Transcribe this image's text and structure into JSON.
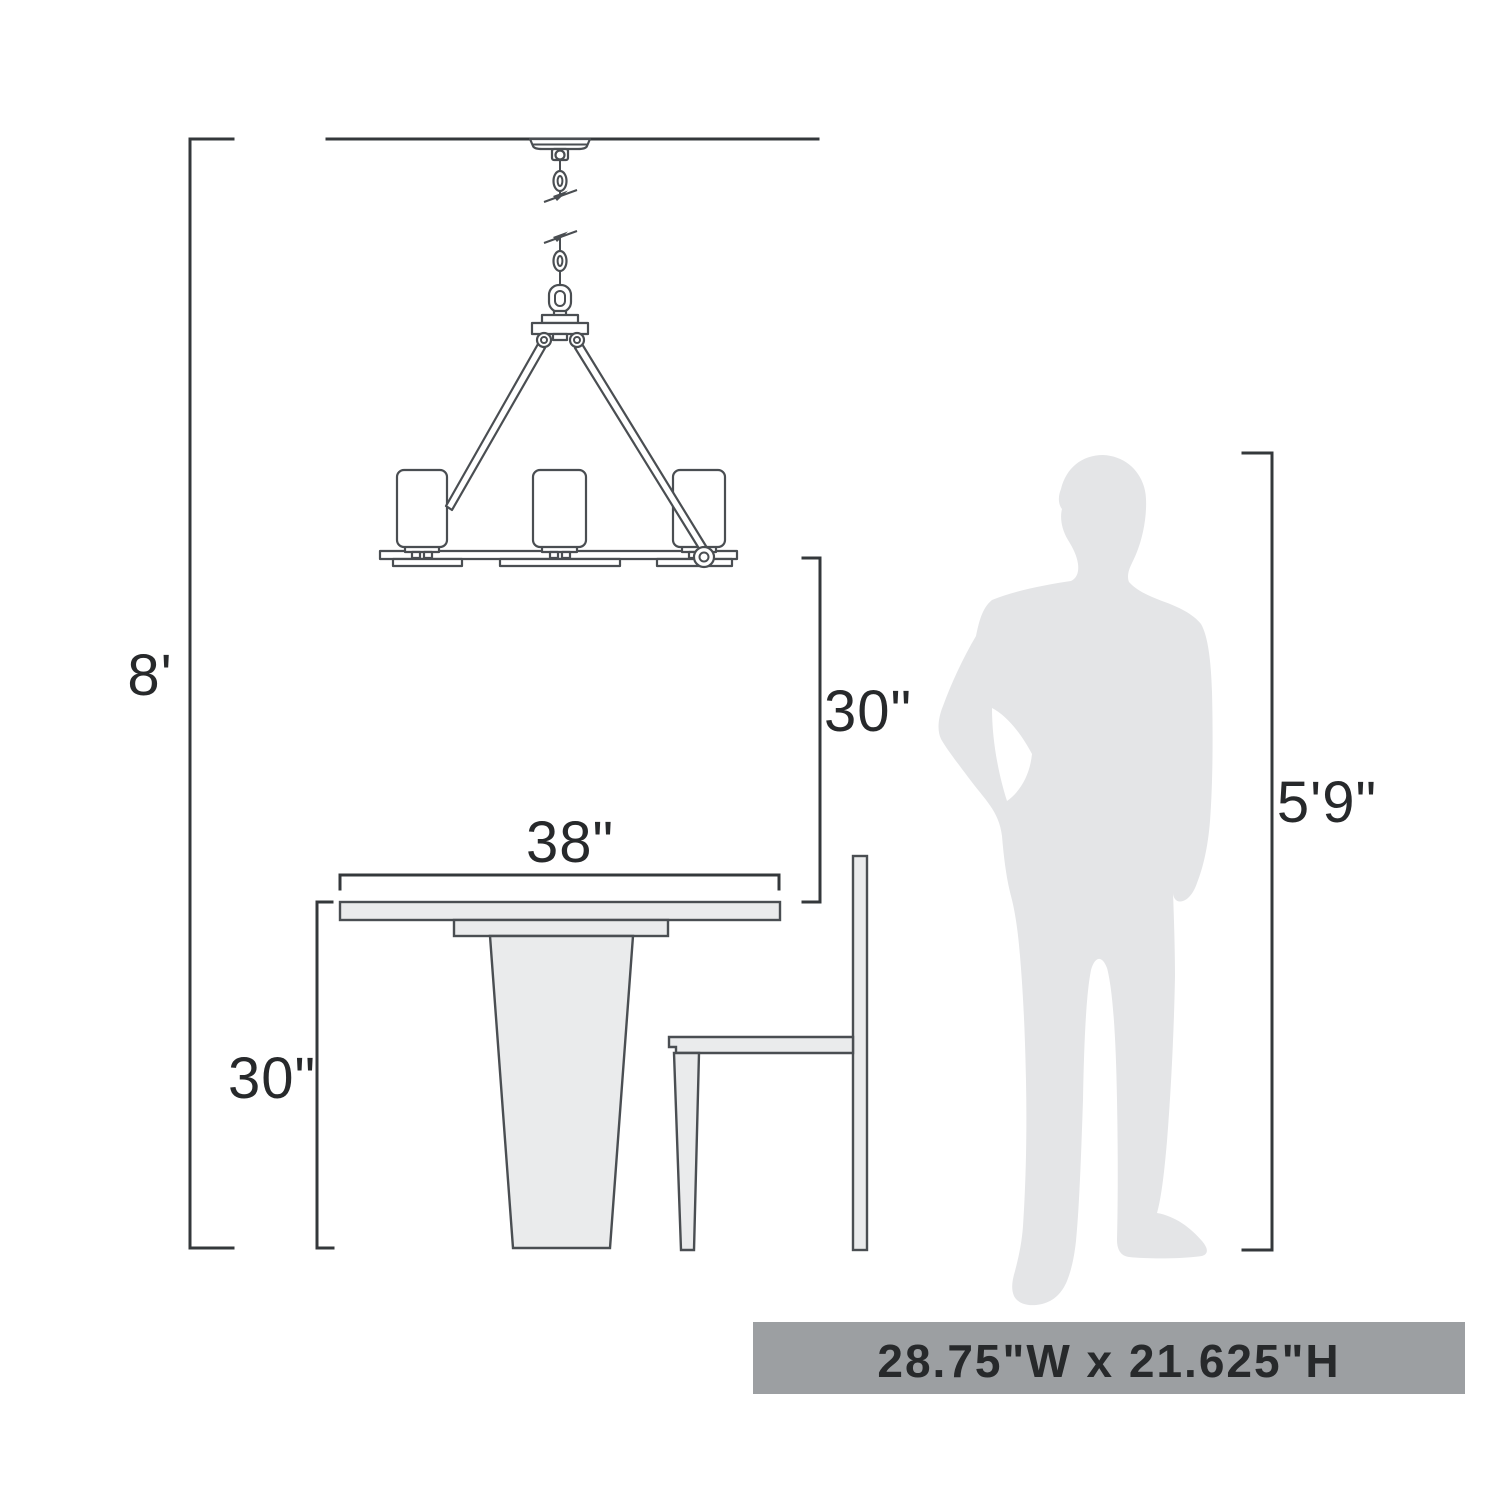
{
  "diagram": {
    "objects": [
      "chandelier",
      "dining-table",
      "chair",
      "person-silhouette"
    ]
  },
  "dimensions": {
    "ceiling_height": "8'",
    "chandelier_to_table": "30\"",
    "table_width": "38\"",
    "table_height": "30\"",
    "person_height": "5'9\""
  },
  "banner": {
    "text": "28.75\"W x 21.625\"H",
    "bg": "#9c9fa2",
    "text_color": "#ffffff"
  },
  "colors": {
    "background": "#ffffff",
    "line_art": "#4a4e52",
    "dimension_lines": "#34383b",
    "label_text": "#27292b",
    "furniture_fill": "#eaebec",
    "silhouette_fill": "#e4e5e7"
  }
}
